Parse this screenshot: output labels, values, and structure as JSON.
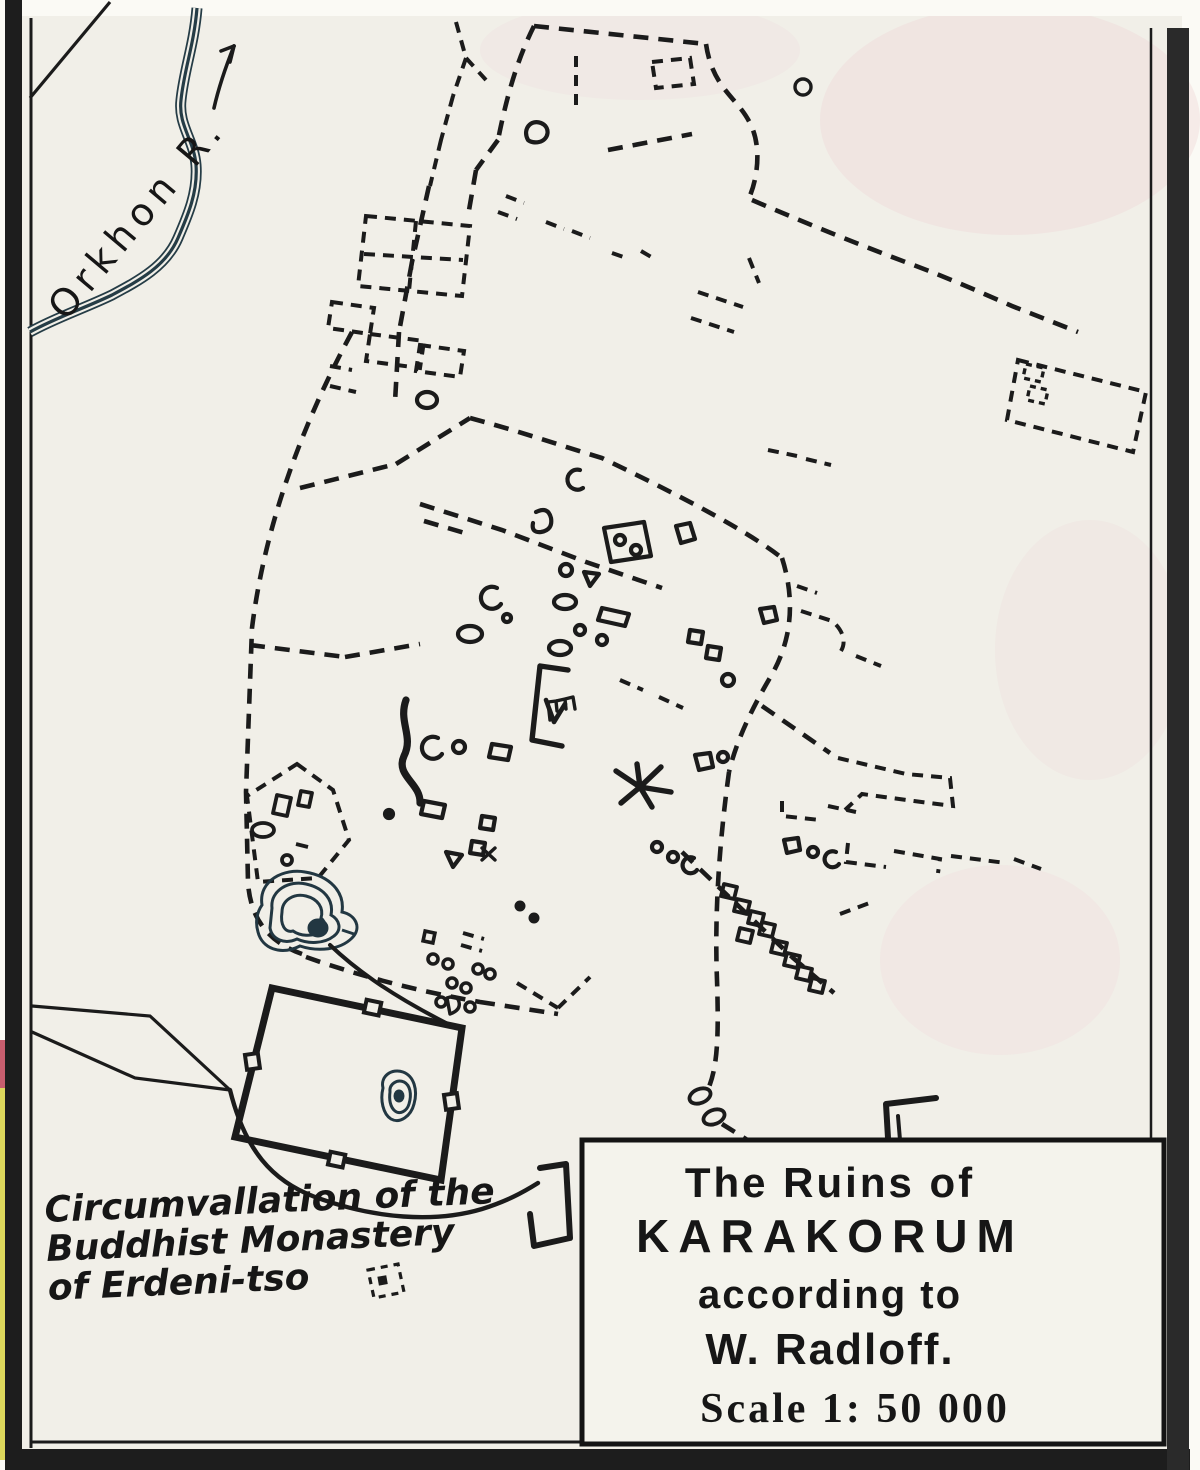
{
  "map": {
    "type": "historical-archaeological-map",
    "river_label": "Orkhon R.",
    "monastery_caption": {
      "line1": "Circumvallation of the",
      "line2": "Buddhist Monastery",
      "line3": "of Erdeni-tso"
    },
    "title_box": {
      "line1": "The Ruins of",
      "line2": "KARAKORUM",
      "line3": "according to",
      "line4": "W. Radloff.",
      "scale": "Scale 1: 50 000"
    },
    "icons": {
      "flow_arrow": "river-flow-direction-arrow",
      "ruin_outlines": "dashed-ruin-walls",
      "contour_hills": "contour-hill-mounds"
    },
    "colors": {
      "paper": "#f1efe8",
      "ink": "#1b1b1b",
      "river_blue": "#253c46",
      "frame_black": "#1d1d1d",
      "edge_yellow": "#ddd75c",
      "edge_red": "#c75e6e",
      "tint_pink": "#f2dede"
    }
  }
}
